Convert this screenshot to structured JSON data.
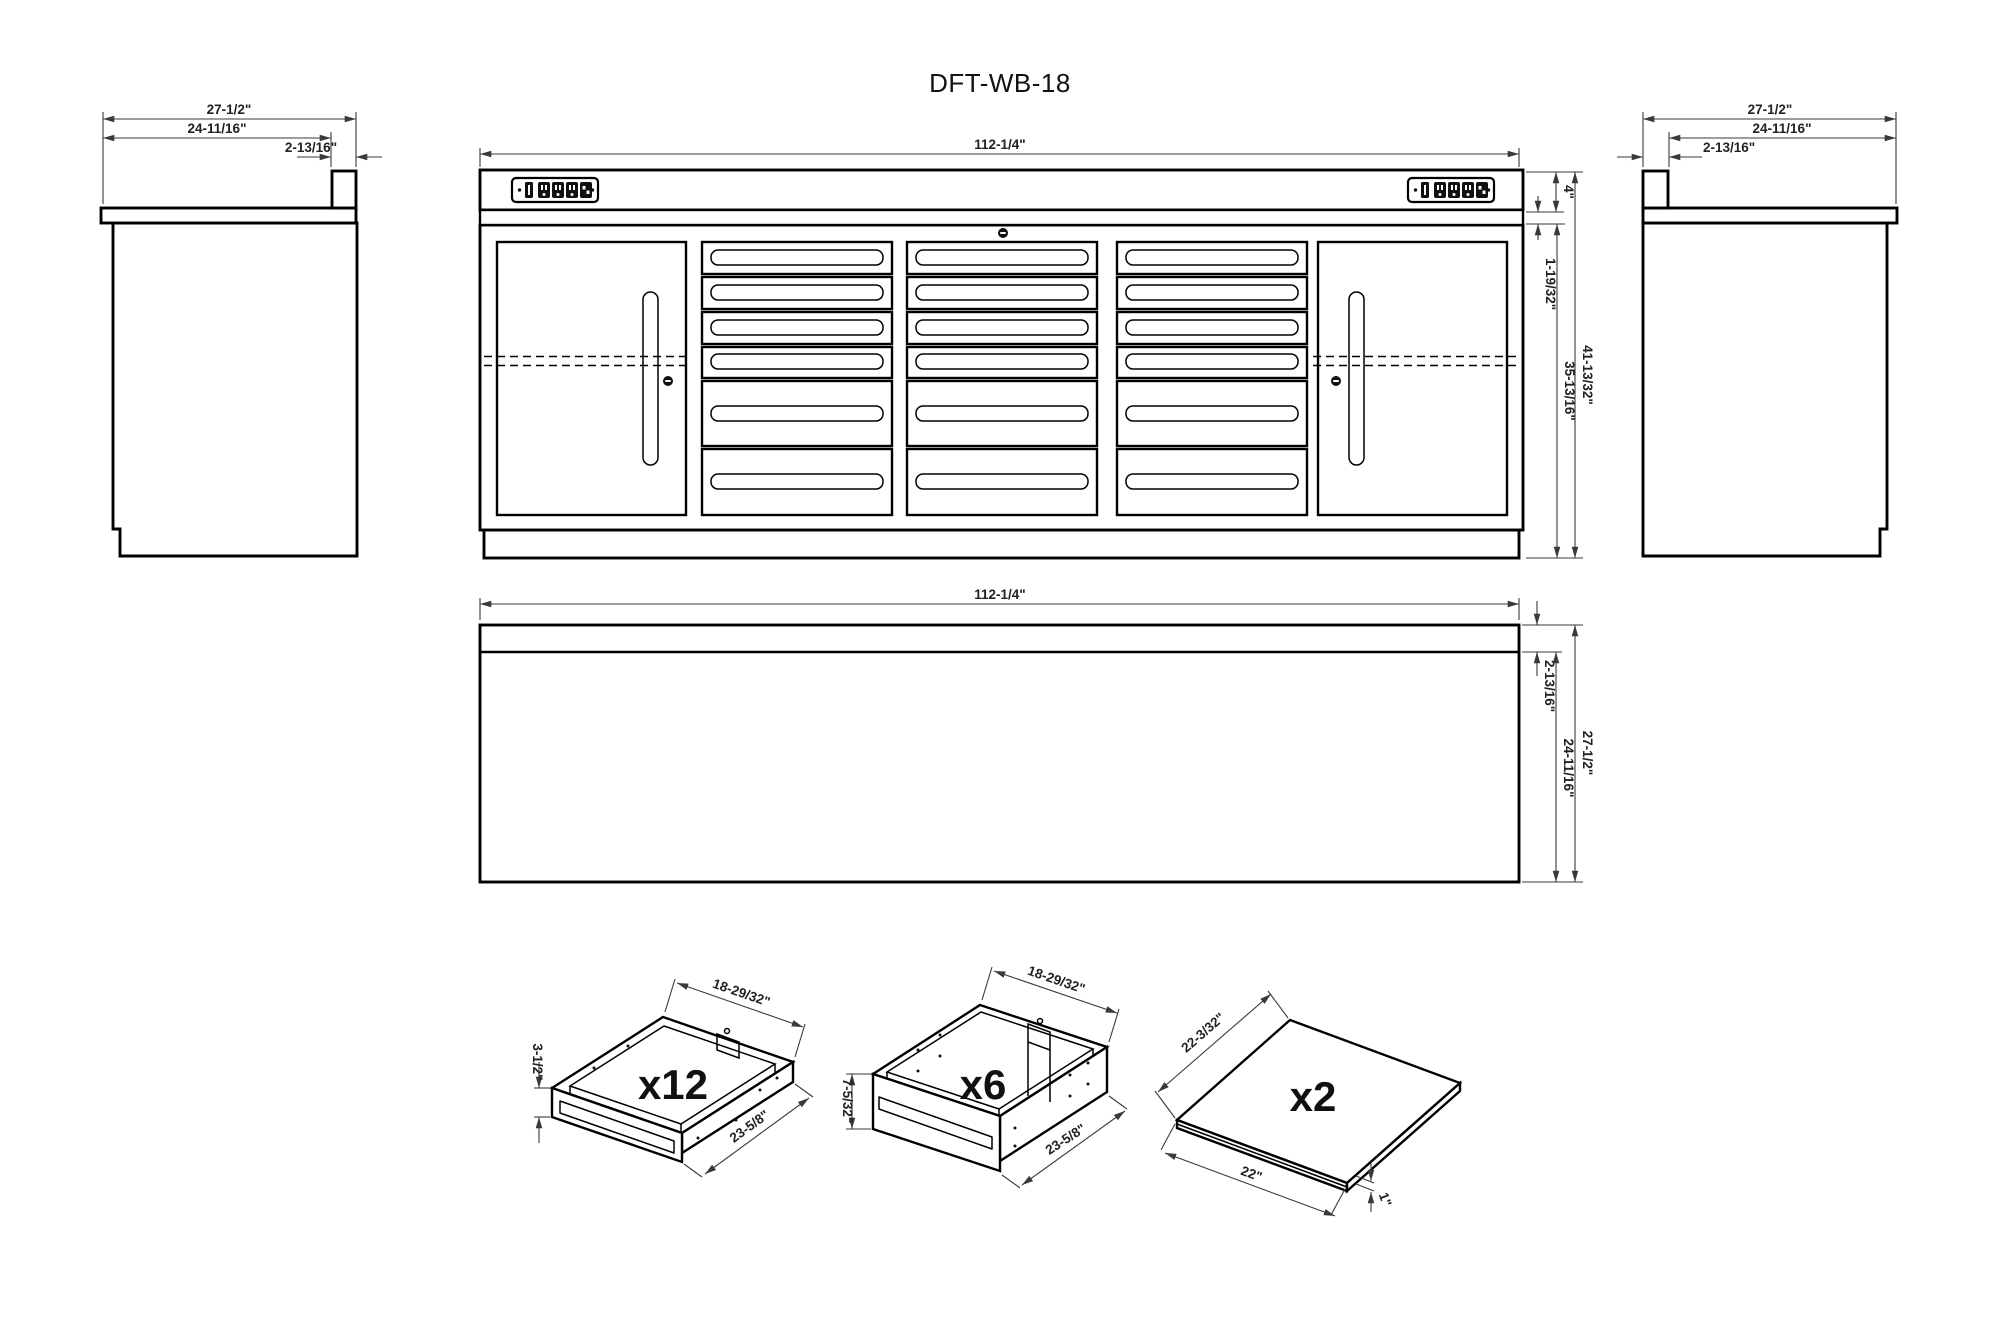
{
  "title": "DFT-WB-18",
  "front_view": {
    "width": "112-1/4\"",
    "worktop_height": "4\"",
    "rail_height": "1-19/32\"",
    "total_height": "41-13/32\"",
    "cabinet_height": "35-13/16\""
  },
  "left_side_view": {
    "depth": "27-1/2\"",
    "body_depth": "24-11/16\"",
    "backsplash_depth": "2-13/16\""
  },
  "right_side_view": {
    "depth": "27-1/2\"",
    "body_depth": "24-11/16\"",
    "backsplash_depth": "2-13/16\""
  },
  "top_view": {
    "width": "112-1/4\"",
    "backsplash_depth": "2-13/16\"",
    "body_depth": "24-11/16\"",
    "depth": "27-1/2\""
  },
  "details": {
    "small_drawer": {
      "count": "x12",
      "width": "18-29/32\"",
      "height": "3-1/2\"",
      "depth": "23-5/8\""
    },
    "deep_drawer": {
      "count": "x6",
      "width": "18-29/32\"",
      "height": "7-5/32\"",
      "depth": "23-5/8\""
    },
    "shelf": {
      "count": "x2",
      "width": "22-3/32\"",
      "depth": "22\"",
      "thickness": "1\""
    }
  },
  "colors": {
    "background": "#ffffff",
    "line": "#000000",
    "dimension": "#3a3a3a",
    "text": "#1f1f1f"
  }
}
